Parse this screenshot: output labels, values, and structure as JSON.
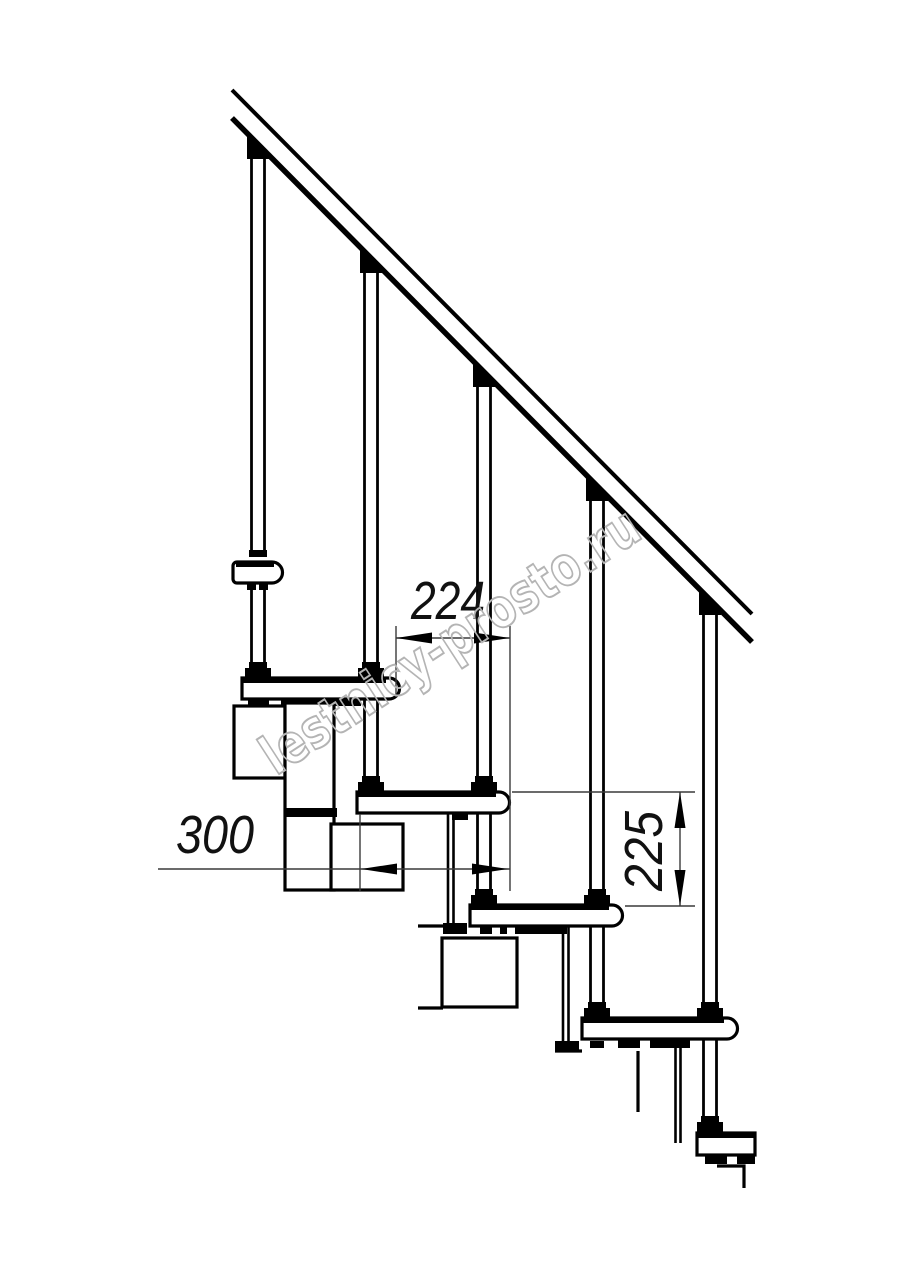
{
  "drawing": {
    "kind": "staircase-side-elevation",
    "colors": {
      "line": "#000000",
      "background": "#ffffff",
      "dimension_line": "#3a3a3a",
      "watermark": "#b4b4b4"
    },
    "dimensions": {
      "step_run": {
        "value": "224"
      },
      "tread_depth": {
        "value": "300"
      },
      "step_rise": {
        "value": "225"
      }
    },
    "watermark": {
      "text": "lestnicy-prosto.ru"
    }
  }
}
